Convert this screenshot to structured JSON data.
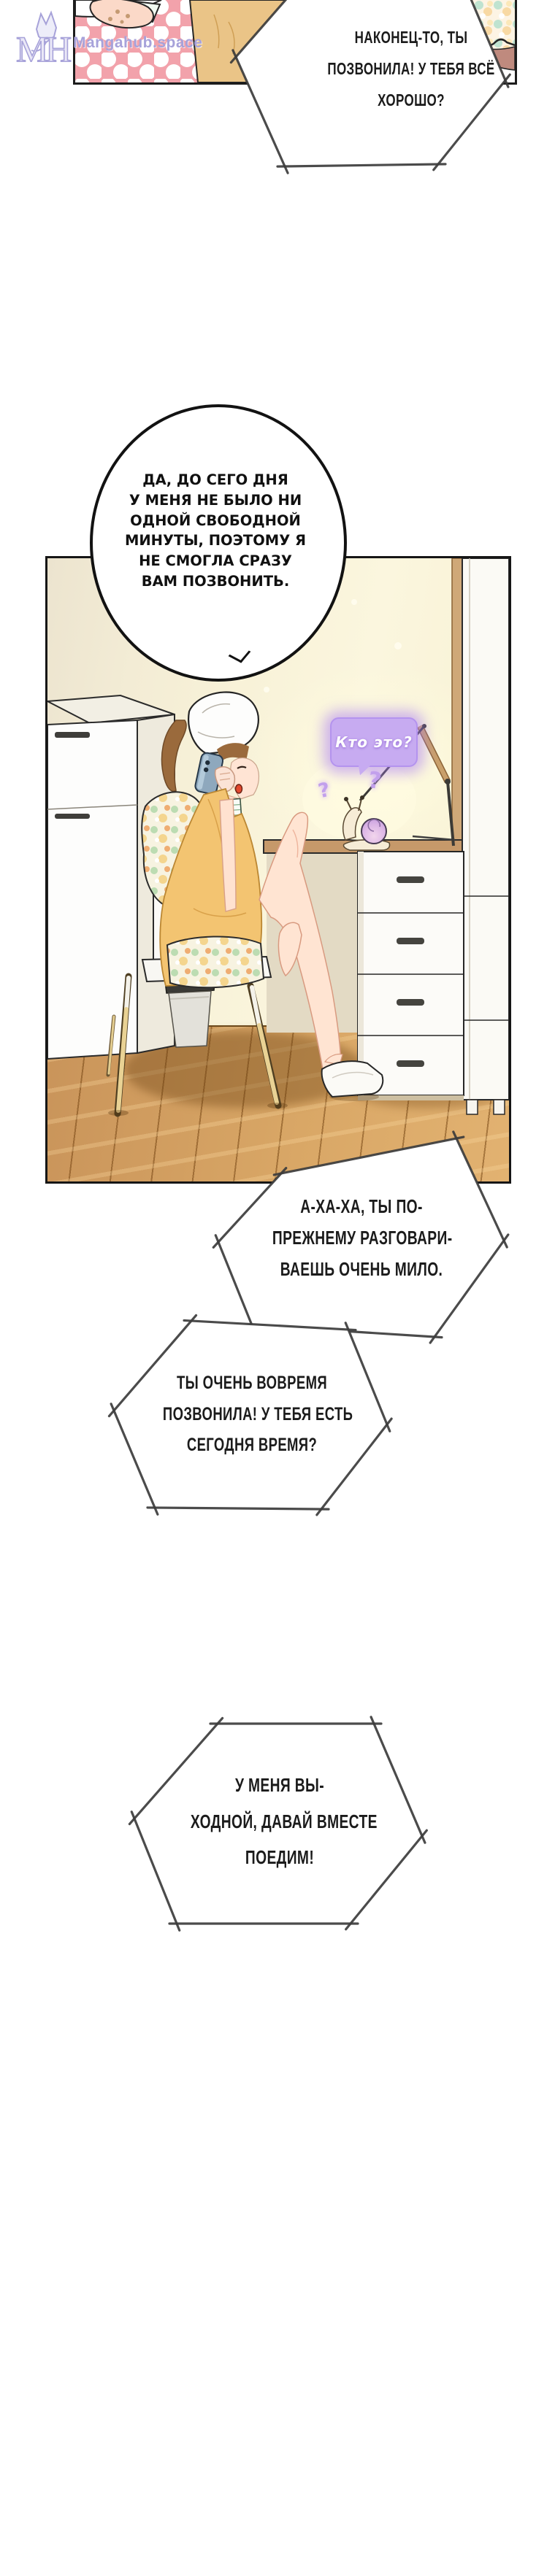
{
  "watermark": {
    "logo_text": "MH",
    "site": "Mangahub.space"
  },
  "speech": {
    "b1": {
      "lines": [
        "НАКОНЕЦ-ТО, ТЫ",
        "ПОЗВОНИЛА! У ТЕБЯ ВСЁ",
        "ХОРОШО?"
      ]
    },
    "b2": {
      "lines": [
        "ДА, ДО СЕГО ДНЯ",
        "У МЕНЯ НЕ БЫЛО НИ",
        "ОДНОЙ СВОБОДНОЙ",
        "МИНУТЫ, ПОЭТОМУ Я",
        "НЕ СМОГЛА СРАЗУ",
        "ВАМ ПОЗВОНИТЬ."
      ]
    },
    "snail_bubble": {
      "text": "Кто это?"
    },
    "question_marks": [
      "?",
      "?"
    ],
    "b3": {
      "lines": [
        "А-ХА-ХА, ТЫ ПО-",
        "ПРЕЖНЕМУ РАЗГОВАРИ-",
        "ВАЕШЬ ОЧЕНЬ МИЛО."
      ]
    },
    "b4": {
      "lines": [
        "ТЫ ОЧЕНЬ ВОВРЕМЯ",
        "ПОЗВОНИЛА! У ТЕБЯ ЕСТЬ",
        "СЕГОДНЯ ВРЕМЯ?"
      ]
    },
    "b5": {
      "lines": [
        "У МЕНЯ ВЫ-",
        "ХОДНОЙ, ДАВАЙ ВМЕСТЕ",
        "ПОЕДИМ!"
      ]
    }
  },
  "colors": {
    "wm": "#a7a2da",
    "polka": "#f2a2ab",
    "dress": "#f3c471",
    "wall": "#f8f2d8",
    "floor": "#d9a766",
    "ktofill": "#c7abf1",
    "pborder": "#1c1c1c",
    "bborder": "#3c3c3c"
  }
}
